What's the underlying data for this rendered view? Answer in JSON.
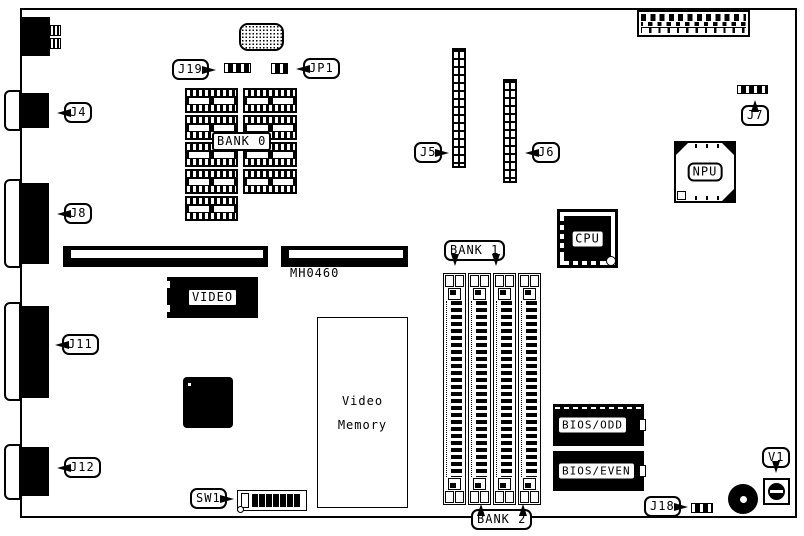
{
  "diagram": {
    "kind": "motherboard-layout",
    "part_number": "MH0460",
    "colors": {
      "ink": "#000000",
      "paper": "#ffffff"
    }
  },
  "callouts": {
    "j19": "J19",
    "jp1": "JP1",
    "j4": "J4",
    "j7": "J7",
    "j5": "J5",
    "j6": "J6",
    "j8": "J8",
    "j11": "J11",
    "j12": "J12",
    "sw1": "SW1",
    "j18": "J18",
    "v1": "V1",
    "bank1": "BANK 1",
    "bank2": "BANK 2"
  },
  "components": {
    "bank0": "BANK 0",
    "video": "VIDEO",
    "cpu": "CPU",
    "npu": "NPU",
    "bios_odd": "BIOS/ODD",
    "bios_even": "BIOS/EVEN",
    "video_memory": {
      "line1": "Video",
      "line2": "Memory"
    }
  }
}
